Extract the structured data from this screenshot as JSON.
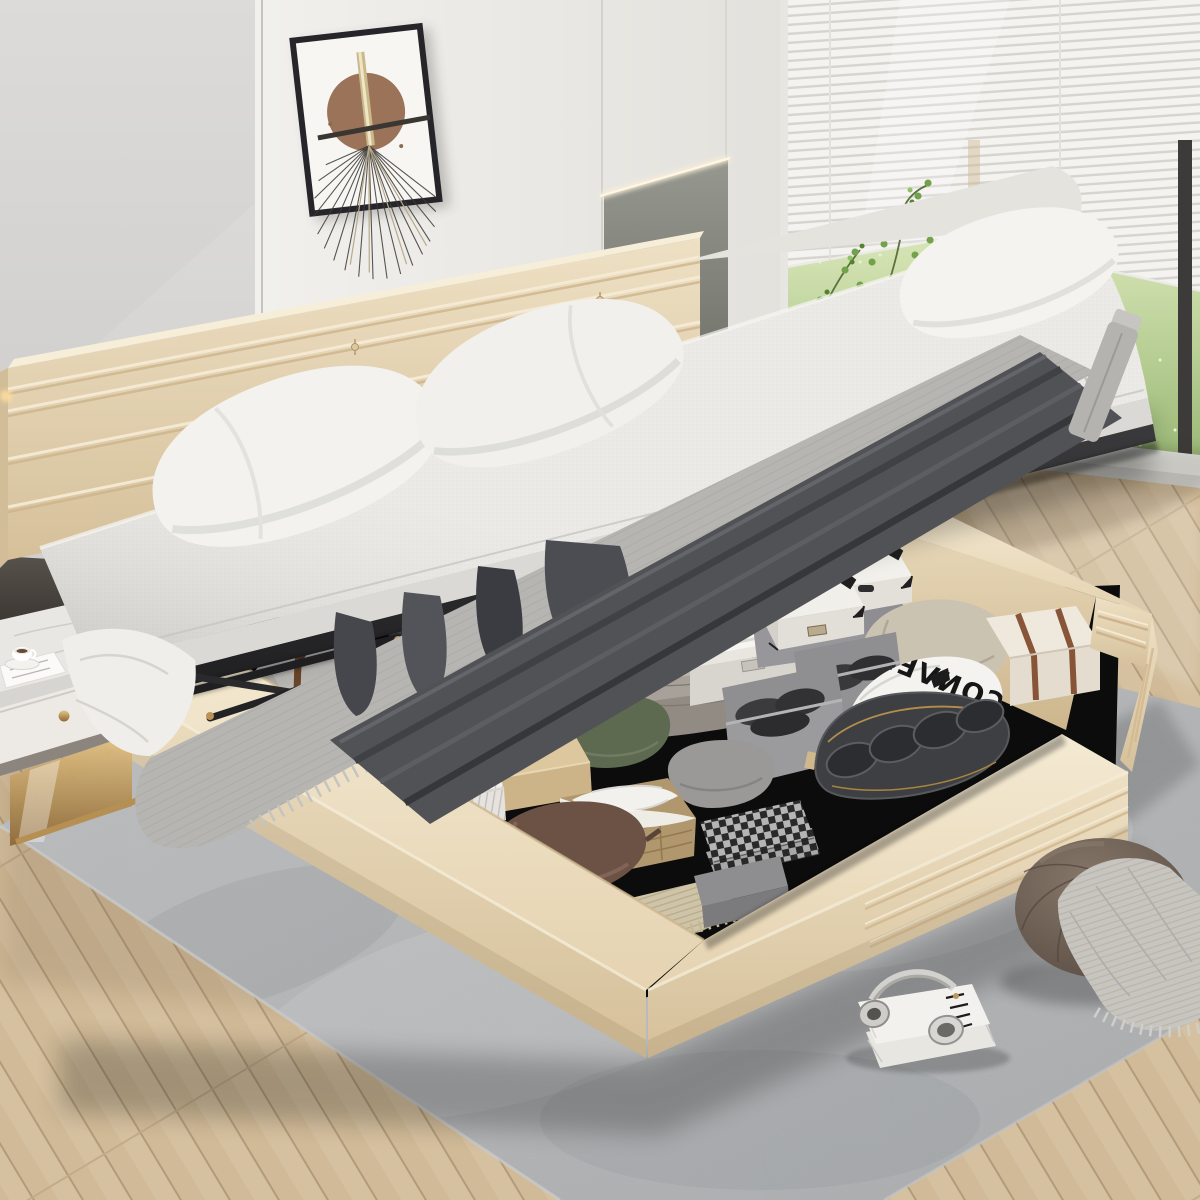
{
  "image": {
    "type": "product-photo",
    "subject": "Upholstered platform bed with hydraulic lift-up storage, mattress raised to show under-bed compartment",
    "setting": "modern bedroom with paneled wall, window with blinds, wood floor and gray rug"
  },
  "texts": {
    "shoe_bag_brand": "CONVERSE"
  },
  "palette": {
    "bed_upholstery": "#ead9bb",
    "mattress": "#e9e8e4",
    "blanket_dark": "#515256",
    "throw_gray": "#b6b5b2",
    "wall": "#d4d3d1",
    "accent_panel": "#8b8d8a",
    "grass": "#b9d193",
    "wood_floor": "#d4bf9e",
    "rug": "#b4b6b8",
    "storage_void": "#0d0d0d",
    "metal_frame": "#2a2a2c",
    "gold_accent": "#c2a26a",
    "pouf": "#6f6158"
  },
  "scene": {
    "wall_art": {
      "label": "abstract art print with brown circle, gold bar and fan of lines"
    },
    "window": {
      "label": "window with white venetian blinds and lawn view"
    },
    "plant": {
      "label": "green plant sprigs"
    },
    "nightstand": {
      "label": "white nightstand with gold base, coffee cup and magazine"
    },
    "bed": {
      "headboard": "channel-tufted beige headboard",
      "mattress": "lifted mattress with white pillows, gray throw and dark folded blanket",
      "frame": "beige upholstered storage base with channel-tufted corners",
      "mechanism": "black hydraulic lift arms"
    },
    "storage_items": [
      {
        "label": "checkered hard-shell suitcase"
      },
      {
        "label": "white travel trunk with leather straps"
      },
      {
        "label": "white duffel bag with brown straps"
      },
      {
        "label": "brown monogram bag"
      },
      {
        "label": "stack of folded gray sweaters"
      },
      {
        "label": "white storage box with folded shirt"
      },
      {
        "label": "white storage boxes with black corner guards"
      },
      {
        "label": "gray fabric bins with folded dark clothes"
      },
      {
        "label": "white shoe bag printed CONVERSE"
      },
      {
        "label": "dark shoe organizer with oval pockets"
      },
      {
        "label": "cream suitcase with brown stripes"
      },
      {
        "label": "beige pillow"
      },
      {
        "label": "green pillow"
      },
      {
        "label": "gray pillow"
      },
      {
        "label": "brown satin pillow"
      },
      {
        "label": "wicker basket with white liner"
      },
      {
        "label": "black and white gingham blanket"
      },
      {
        "label": "beige knit throw"
      },
      {
        "label": "white pinstripe box"
      },
      {
        "label": "tan box"
      },
      {
        "label": "gray box"
      }
    ],
    "floor_items": [
      {
        "label": "round velvet pouf with knit throw"
      },
      {
        "label": "stack of books"
      },
      {
        "label": "white wireless headphones"
      },
      {
        "label": "gray area rug"
      }
    ]
  }
}
